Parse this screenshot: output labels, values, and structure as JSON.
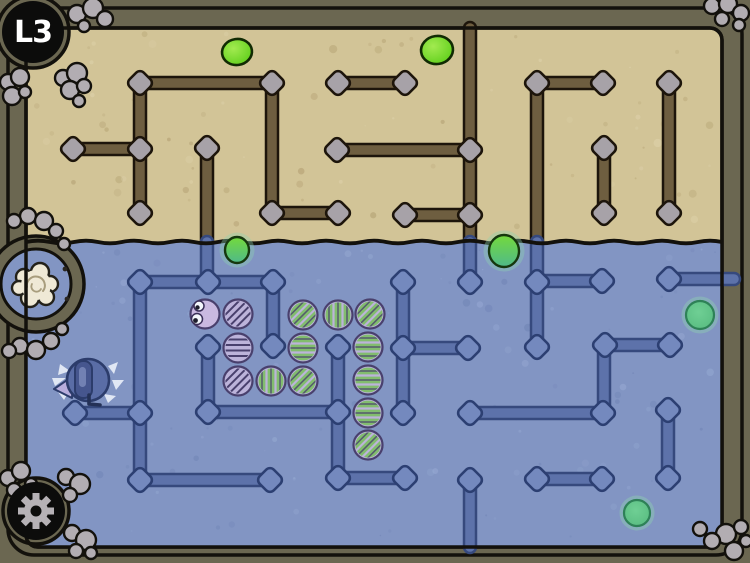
{
  "hud": {
    "level_label": "L3",
    "settings_icon": "gear-icon"
  },
  "palette": {
    "bg": "#6b6751",
    "outline": "#13110c",
    "sand": "#d2c497",
    "sand_speck": "#ab9768",
    "sand_speck_light": "#e2d7b2",
    "water": "#8295c3",
    "water_speck_dark": "#6b7fb1",
    "water_speck_light": "#9db0d8",
    "wall_sand_fill": "#6e5e40",
    "wall_sand_edge": "#1d150b",
    "node_sand_fill": "#a7a2a8",
    "wall_water_fill": "#5d72aa",
    "wall_water_edge": "#36497d",
    "node_water_fill": "#7489be",
    "node_water_edge": "#2c3f72",
    "pod_fill": "#bcb3da",
    "pod_eyes_fill": "#c9b9e0",
    "pod_line": "#49406d",
    "pod_green": "#82bd6e",
    "blob_sand_core": "#a2ea50",
    "blob_sand": "#58cc15",
    "blob_sand_edge": "#112b03",
    "blob_water": "#55b97e",
    "blob_water_core": "#6fcf94",
    "blob_water_edge": "#2e8157",
    "rock": "#b2adb2",
    "cocoon": "#efe9d6",
    "cocoon_line": "#a89d7d",
    "player_body": "#5a6da6",
    "player_edge": "#2c3c6b",
    "player_fin": "#b7addc",
    "player_splash": "#e8eef8",
    "gear": "#b6b2b6"
  },
  "scene": {
    "outer": {
      "x": 8,
      "y": 8,
      "w": 734,
      "h": 547,
      "rx": 26
    },
    "field": {
      "x": 26,
      "y": 28,
      "w": 696,
      "h": 519,
      "rx": 12
    },
    "water_y": 242,
    "bulges": [
      [
        33,
        32,
        36
      ],
      [
        36,
        511,
        33
      ]
    ],
    "alcove": {
      "cx": 36,
      "cy": 284,
      "r_outer": 48,
      "r_inner": 35
    },
    "cocoon": {
      "cx": 36,
      "cy": 285,
      "r": 15
    },
    "bolts": [
      [
        65,
        269
      ],
      [
        67,
        299
      ]
    ],
    "walls_sand": [
      [
        140,
        83,
        272,
        83
      ],
      [
        272,
        83,
        272,
        213
      ],
      [
        272,
        213,
        338,
        213
      ],
      [
        140,
        83,
        140,
        213
      ],
      [
        73,
        149,
        140,
        149
      ],
      [
        338,
        83,
        405,
        83
      ],
      [
        337,
        150,
        470,
        150
      ],
      [
        470,
        28,
        470,
        242
      ],
      [
        405,
        215,
        470,
        215
      ],
      [
        207,
        148,
        207,
        242
      ],
      [
        537,
        83,
        537,
        242
      ],
      [
        537,
        83,
        603,
        83
      ],
      [
        604,
        148,
        604,
        213
      ],
      [
        669,
        83,
        669,
        213
      ]
    ],
    "nodes_sand": [
      [
        140,
        83
      ],
      [
        272,
        83
      ],
      [
        272,
        213
      ],
      [
        338,
        213
      ],
      [
        140,
        149
      ],
      [
        140,
        213
      ],
      [
        73,
        149
      ],
      [
        207,
        148
      ],
      [
        338,
        83
      ],
      [
        405,
        83
      ],
      [
        337,
        150
      ],
      [
        470,
        150
      ],
      [
        405,
        215
      ],
      [
        470,
        215
      ],
      [
        537,
        83
      ],
      [
        603,
        83
      ],
      [
        604,
        148
      ],
      [
        604,
        213
      ],
      [
        669,
        83
      ],
      [
        669,
        213
      ]
    ],
    "walls_water": [
      [
        207,
        242,
        207,
        282
      ],
      [
        470,
        242,
        470,
        282
      ],
      [
        537,
        242,
        537,
        347
      ],
      [
        140,
        282,
        273,
        282
      ],
      [
        140,
        282,
        140,
        480
      ],
      [
        273,
        282,
        273,
        346
      ],
      [
        208,
        347,
        208,
        412
      ],
      [
        208,
        412,
        338,
        412
      ],
      [
        338,
        347,
        338,
        478
      ],
      [
        338,
        478,
        405,
        478
      ],
      [
        75,
        413,
        140,
        413
      ],
      [
        140,
        480,
        270,
        480
      ],
      [
        403,
        282,
        403,
        413
      ],
      [
        403,
        348,
        468,
        348
      ],
      [
        470,
        413,
        603,
        413
      ],
      [
        537,
        281,
        602,
        281
      ],
      [
        669,
        279,
        734,
        279
      ],
      [
        605,
        345,
        670,
        345
      ],
      [
        604,
        345,
        604,
        413
      ],
      [
        668,
        410,
        668,
        478
      ],
      [
        537,
        479,
        602,
        479
      ],
      [
        470,
        480,
        470,
        547
      ]
    ],
    "nodes_water": [
      [
        140,
        282
      ],
      [
        208,
        282
      ],
      [
        273,
        282
      ],
      [
        273,
        346
      ],
      [
        208,
        347
      ],
      [
        208,
        412
      ],
      [
        338,
        347
      ],
      [
        338,
        412
      ],
      [
        338,
        478
      ],
      [
        405,
        478
      ],
      [
        75,
        413
      ],
      [
        140,
        413
      ],
      [
        140,
        480
      ],
      [
        270,
        480
      ],
      [
        470,
        282
      ],
      [
        537,
        282
      ],
      [
        537,
        347
      ],
      [
        403,
        282
      ],
      [
        403,
        348
      ],
      [
        403,
        413
      ],
      [
        468,
        348
      ],
      [
        470,
        413
      ],
      [
        603,
        413
      ],
      [
        602,
        281
      ],
      [
        669,
        279
      ],
      [
        605,
        345
      ],
      [
        670,
        345
      ],
      [
        668,
        410
      ],
      [
        668,
        478
      ],
      [
        537,
        479
      ],
      [
        602,
        479
      ],
      [
        470,
        480
      ]
    ],
    "pods": [
      {
        "x": 205,
        "y": 314,
        "kind": "eyes",
        "o": "h"
      },
      {
        "x": 238,
        "y": 314,
        "kind": "plain",
        "o": "d"
      },
      {
        "x": 303,
        "y": 315,
        "kind": "green",
        "o": "d"
      },
      {
        "x": 338,
        "y": 315,
        "kind": "green",
        "o": "v"
      },
      {
        "x": 370,
        "y": 314,
        "kind": "green",
        "o": "d"
      },
      {
        "x": 238,
        "y": 348,
        "kind": "plain",
        "o": "h"
      },
      {
        "x": 303,
        "y": 348,
        "kind": "green",
        "o": "h"
      },
      {
        "x": 368,
        "y": 347,
        "kind": "green",
        "o": "h"
      },
      {
        "x": 238,
        "y": 381,
        "kind": "plain",
        "o": "d"
      },
      {
        "x": 271,
        "y": 381,
        "kind": "green",
        "o": "v"
      },
      {
        "x": 303,
        "y": 381,
        "kind": "green",
        "o": "d"
      },
      {
        "x": 368,
        "y": 380,
        "kind": "green",
        "o": "h"
      },
      {
        "x": 368,
        "y": 413,
        "kind": "green",
        "o": "h"
      },
      {
        "x": 368,
        "y": 445,
        "kind": "green",
        "o": "d"
      }
    ],
    "blobs": [
      {
        "x": 237,
        "y": 52,
        "r": 14,
        "zone": "sand"
      },
      {
        "x": 437,
        "y": 50,
        "r": 15,
        "zone": "sand"
      },
      {
        "x": 237,
        "y": 250,
        "r": 13,
        "zone": "line"
      },
      {
        "x": 504,
        "y": 251,
        "r": 16,
        "zone": "line"
      },
      {
        "x": 700,
        "y": 315,
        "r": 14,
        "zone": "water"
      },
      {
        "x": 637,
        "y": 513,
        "r": 13,
        "zone": "water"
      }
    ],
    "player": {
      "cx": 88,
      "cy": 380,
      "r": 21
    },
    "rocks": [
      [
        77,
        14,
        9
      ],
      [
        93,
        8,
        10
      ],
      [
        105,
        19,
        8
      ],
      [
        84,
        26,
        6
      ],
      [
        8,
        82,
        8
      ],
      [
        20,
        77,
        9
      ],
      [
        12,
        96,
        9
      ],
      [
        25,
        92,
        6
      ],
      [
        63,
        78,
        8
      ],
      [
        77,
        73,
        10
      ],
      [
        70,
        90,
        9
      ],
      [
        84,
        86,
        7
      ],
      [
        79,
        101,
        6
      ],
      [
        712,
        6,
        8
      ],
      [
        728,
        4,
        9
      ],
      [
        741,
        13,
        8
      ],
      [
        722,
        19,
        7
      ],
      [
        739,
        25,
        6
      ],
      [
        700,
        529,
        7
      ],
      [
        726,
        534,
        10
      ],
      [
        741,
        527,
        7
      ],
      [
        712,
        541,
        8
      ],
      [
        734,
        551,
        9
      ],
      [
        746,
        541,
        6
      ],
      [
        8,
        478,
        8
      ],
      [
        21,
        471,
        9
      ],
      [
        14,
        490,
        7
      ],
      [
        31,
        484,
        6
      ],
      [
        66,
        477,
        8
      ],
      [
        80,
        484,
        10
      ],
      [
        70,
        495,
        7
      ],
      [
        72,
        533,
        8
      ],
      [
        86,
        540,
        10
      ],
      [
        76,
        551,
        7
      ],
      [
        91,
        553,
        6
      ],
      [
        28,
        216,
        8
      ],
      [
        44,
        221,
        9
      ],
      [
        14,
        221,
        7
      ],
      [
        56,
        231,
        7
      ],
      [
        64,
        244,
        6
      ],
      [
        20,
        346,
        8
      ],
      [
        36,
        350,
        9
      ],
      [
        51,
        341,
        8
      ],
      [
        9,
        351,
        7
      ],
      [
        62,
        329,
        6
      ]
    ]
  }
}
